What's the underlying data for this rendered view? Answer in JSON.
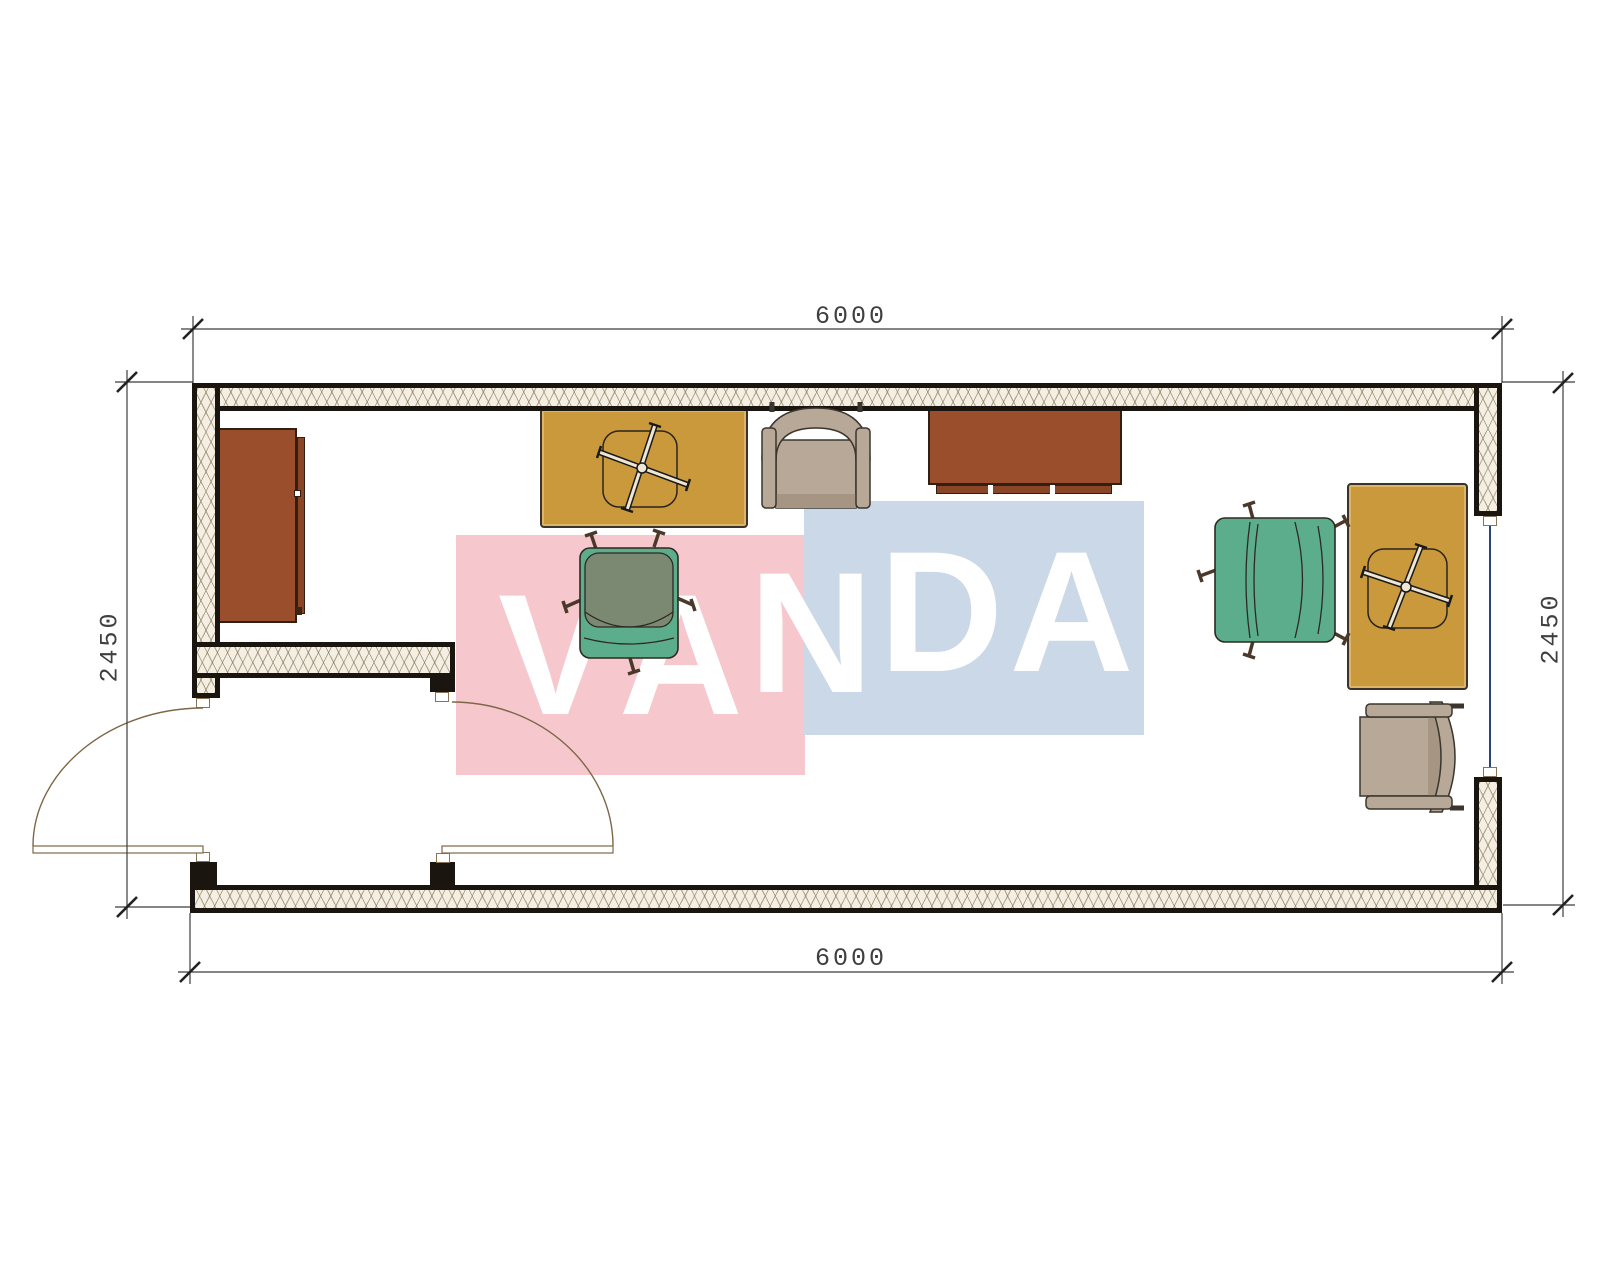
{
  "title": "container-office-floor-plan",
  "dimensions": {
    "top": "6000",
    "bottom": "6000",
    "left": "2450",
    "right": "2450"
  },
  "watermark": {
    "text": "VANDA",
    "pink": "#F6C7CD",
    "blue": "#CBD8E7",
    "letter_color": "#FFFFFF"
  },
  "colors": {
    "wall": "#1A150F",
    "hatch_bg": "#F4EFE2",
    "desk": "#C9993C",
    "wood": "#9B4E2B",
    "chair_teal": "#5CAD8B",
    "chair_olive": "#7B8973",
    "armchair_beige": "#B7A897",
    "armchair_shadow": "#A59582",
    "door_swing": "#7D6747",
    "window_glass": "#2B4475",
    "dim_line": "#3C3C3C",
    "paper": "#FFFFFF"
  },
  "furniture": [
    {
      "name": "cabinet",
      "type": "tall storage cabinet"
    },
    {
      "name": "desk-1",
      "type": "desk with task chair tucked under"
    },
    {
      "name": "armchair-1",
      "type": "upholstered armchair"
    },
    {
      "name": "sideboard",
      "type": "low sideboard on plinth"
    },
    {
      "name": "office-chair-1",
      "type": "swivel office chair"
    },
    {
      "name": "office-chair-2",
      "type": "swivel office chair"
    },
    {
      "name": "desk-2",
      "type": "desk with task chair tucked under"
    },
    {
      "name": "armchair-2",
      "type": "upholstered armchair"
    }
  ],
  "openings": [
    {
      "name": "door-west",
      "type": "outward swinging entry door"
    },
    {
      "name": "door-east",
      "type": "inward swinging vestibule door"
    },
    {
      "name": "window-east",
      "type": "window in east wall"
    }
  ]
}
